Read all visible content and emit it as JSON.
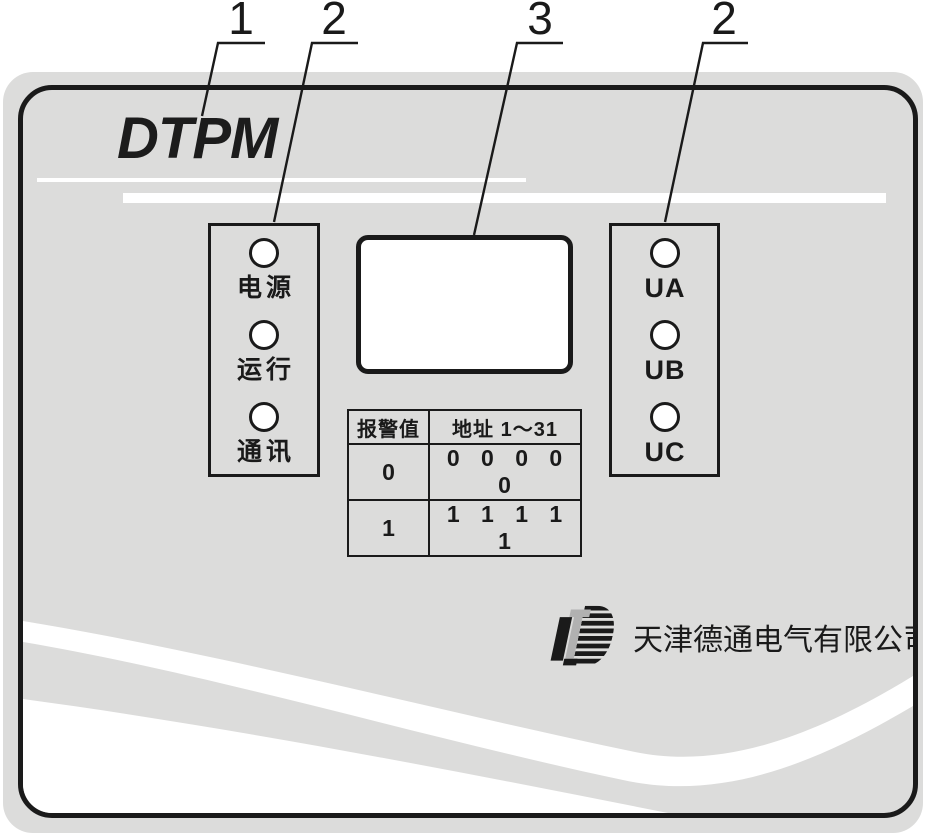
{
  "figure": {
    "type": "device-front-panel-diagram",
    "callouts": [
      {
        "label": "1",
        "points_to": "panel-wordmark"
      },
      {
        "label": "2",
        "points_to": "status-led-group"
      },
      {
        "label": "3",
        "points_to": "lcd-display"
      },
      {
        "label": "2",
        "points_to": "phase-led-group"
      }
    ]
  },
  "brand": {
    "wordmark": "DTPM"
  },
  "panels": {
    "left": {
      "leds": [
        {
          "label": "电源"
        },
        {
          "label": "运行"
        },
        {
          "label": "通讯"
        }
      ]
    },
    "right": {
      "leds": [
        {
          "label": "UA"
        },
        {
          "label": "UB"
        },
        {
          "label": "UC"
        }
      ]
    }
  },
  "display": {
    "content": ""
  },
  "table": {
    "headers": [
      "报警值",
      "地址 1～31"
    ],
    "rows": [
      [
        "0",
        "0 0 0 0 0"
      ],
      [
        "1",
        "1 1 1 1 1"
      ]
    ]
  },
  "footer": {
    "company": "天津德通电气有限公司",
    "logo": "detong-logo"
  },
  "colors": {
    "panel_gray": "#dcdcdb",
    "ink": "#1a1a1a",
    "logo_gray": "#b1b1b1",
    "wave_white": "#ffffff"
  }
}
